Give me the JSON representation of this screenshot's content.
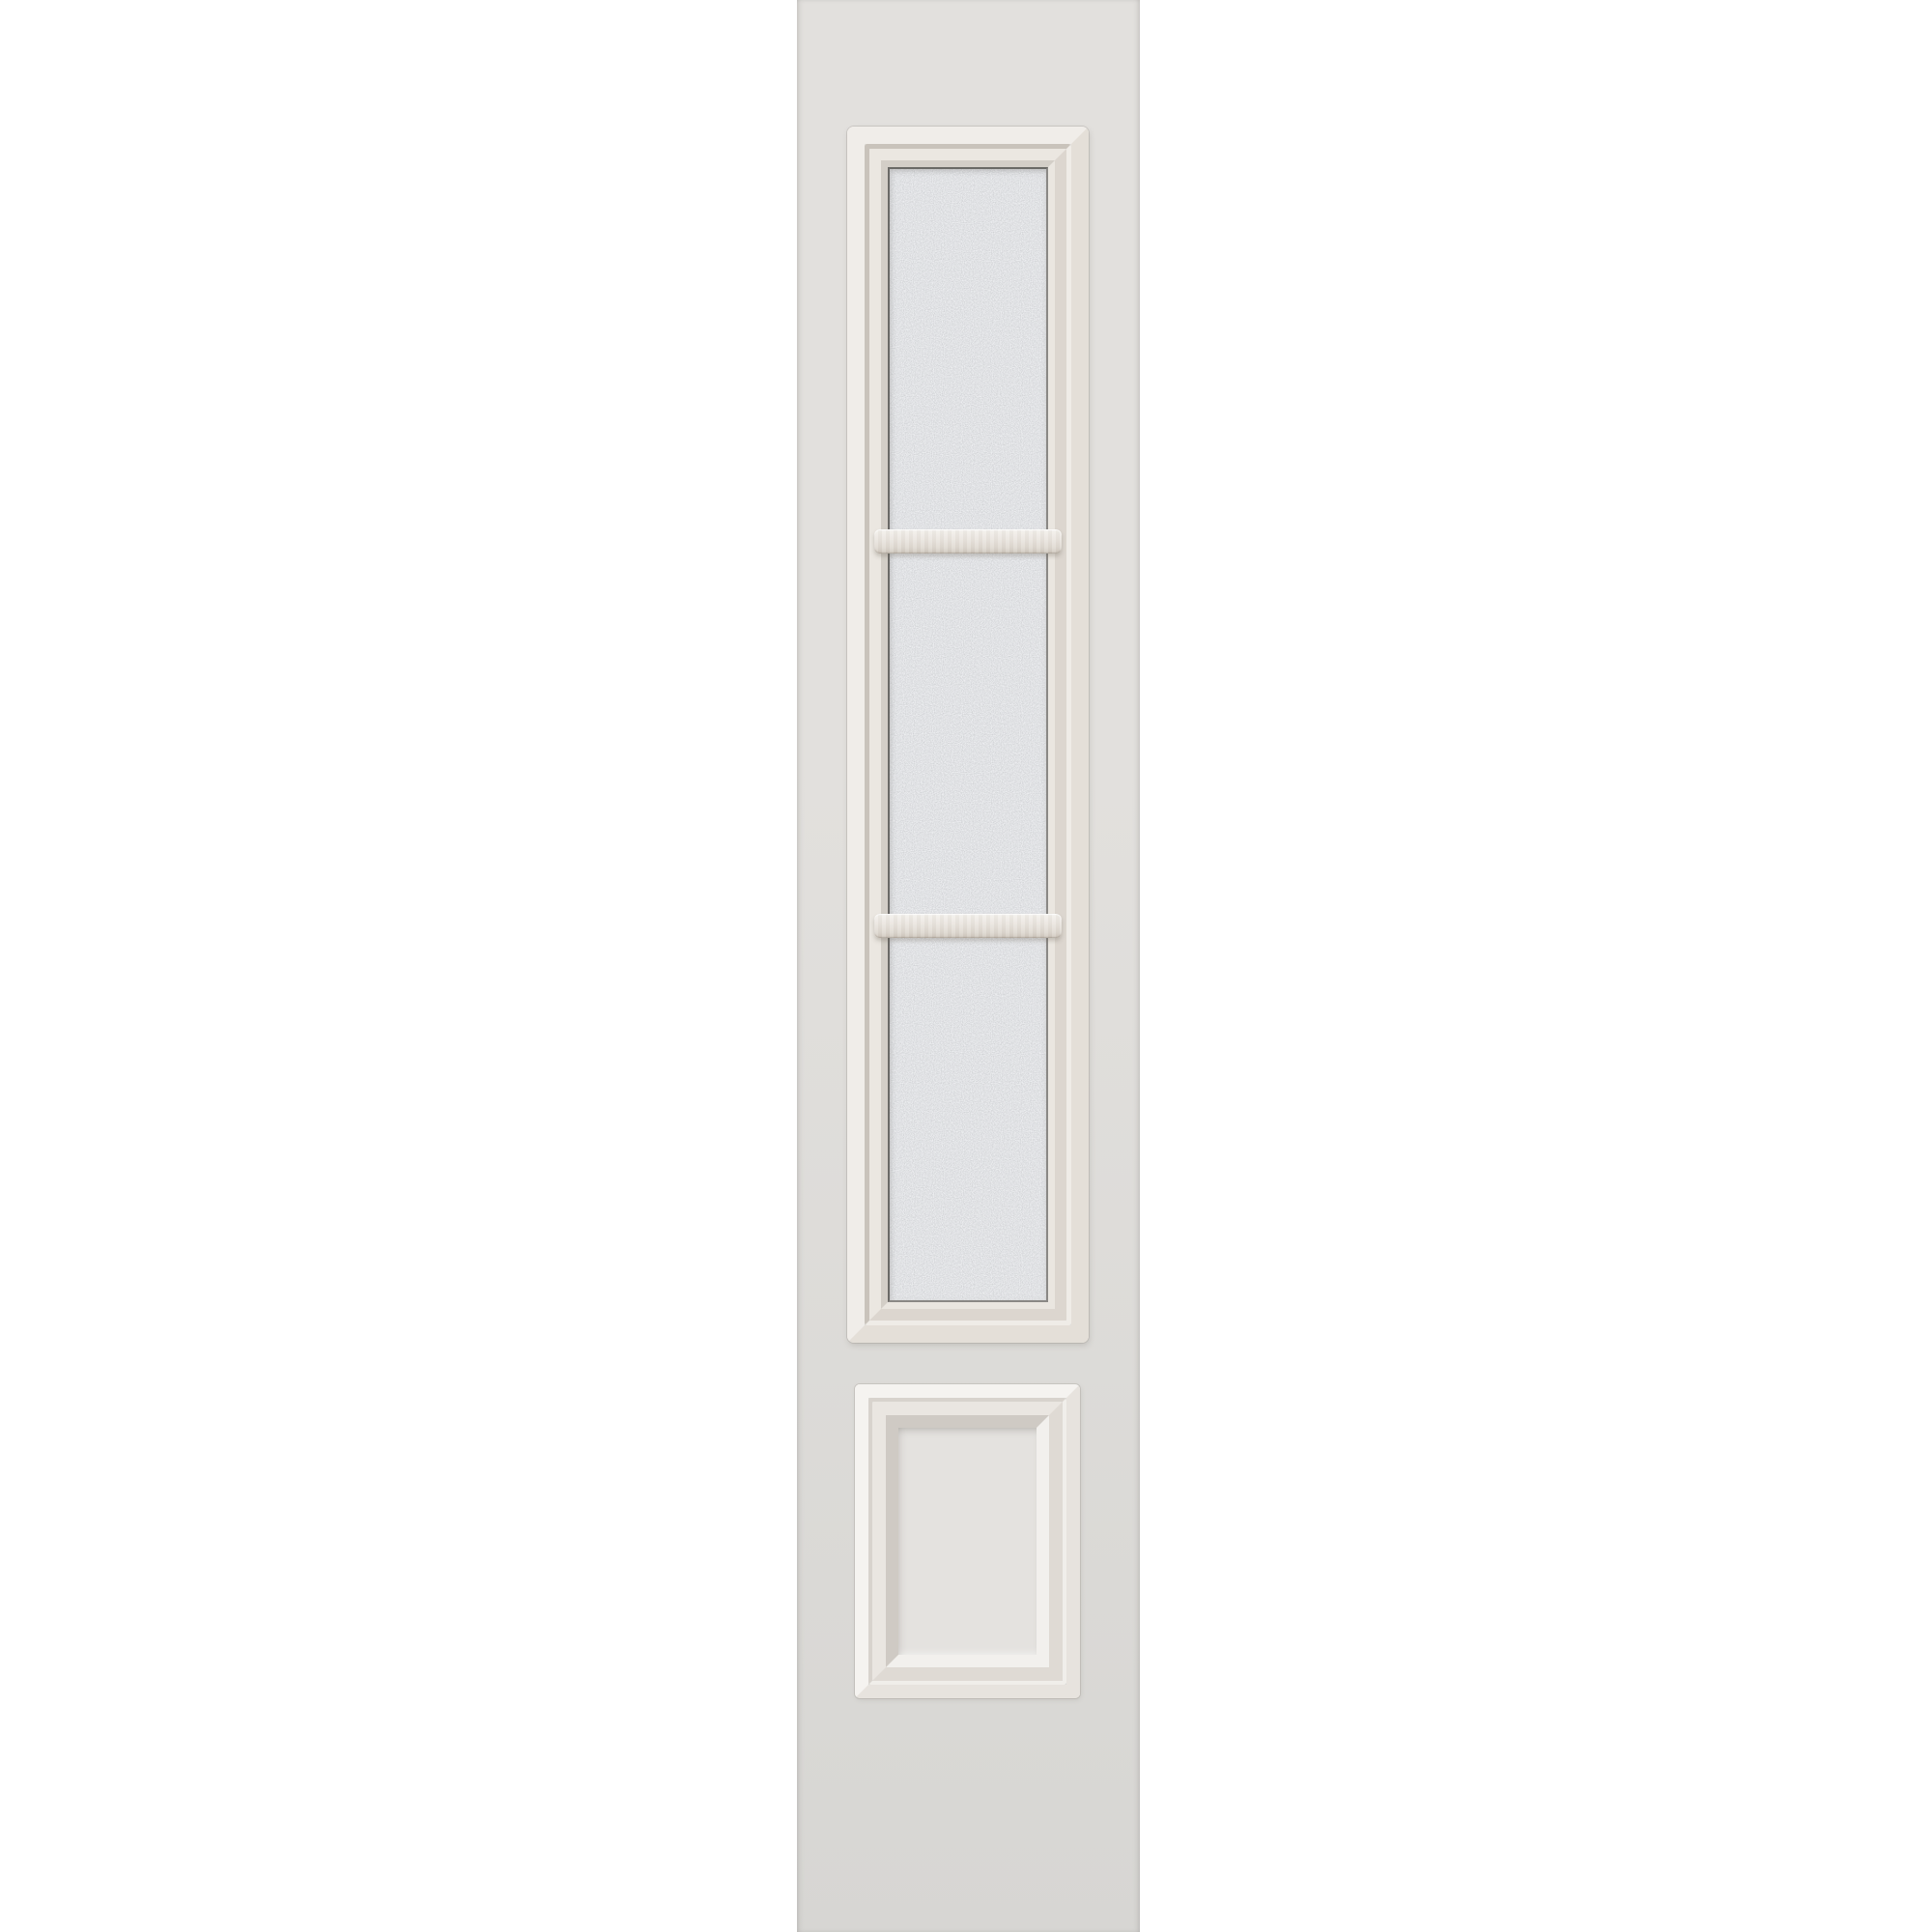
{
  "image": {
    "subject": "door-sidelight-product-photo",
    "description": "Tall off-white door sidelight slab with a three-lite frosted privacy-glass window divided by two horizontal muntin bars, and one raised square panel below",
    "background_color": "#ffffff"
  },
  "sidelight": {
    "glass_lites": 3,
    "muntin_bars": 2,
    "raised_panels": 1,
    "glass_texture": "frosted-granite"
  },
  "colors": {
    "background": "#ffffff",
    "slab_top": "#e2e0dd",
    "slab_bottom": "#d7d6d3",
    "frame_flat_light": "#f0ede9",
    "frame_flat_dark": "#e4dfd8",
    "frame_groove_dark": "#c9c3bb",
    "frame_groove_light": "#efece7",
    "frame_band_light": "#ebe7e1",
    "frame_band_dark": "#dcd6cf",
    "frame_slope_dark": "#d3cec7",
    "frame_slope_light": "#eae6e0",
    "glass_edge_dark": "#6a6966",
    "glass_edge_soft": "#8a8885",
    "glass_base": "#c8cacc",
    "muntin_top": "#f4f1ed",
    "muntin_mid": "#e9e4de",
    "muntin_low": "#ded8d0",
    "muntin_bottom": "#cdc5bb",
    "panel_flat_light": "#f5f3f0",
    "panel_flat_dark": "#e7e3de",
    "panel_groove_dark": "#d8d3cd",
    "panel_groove_light": "#f0eeea",
    "panel_band_light": "#eae6e1",
    "panel_band_dark": "#dfdad4",
    "panel_slope_dark": "#cfcac4",
    "panel_slope_light": "#f2f0ed",
    "panel_center": "#e4e2df"
  }
}
